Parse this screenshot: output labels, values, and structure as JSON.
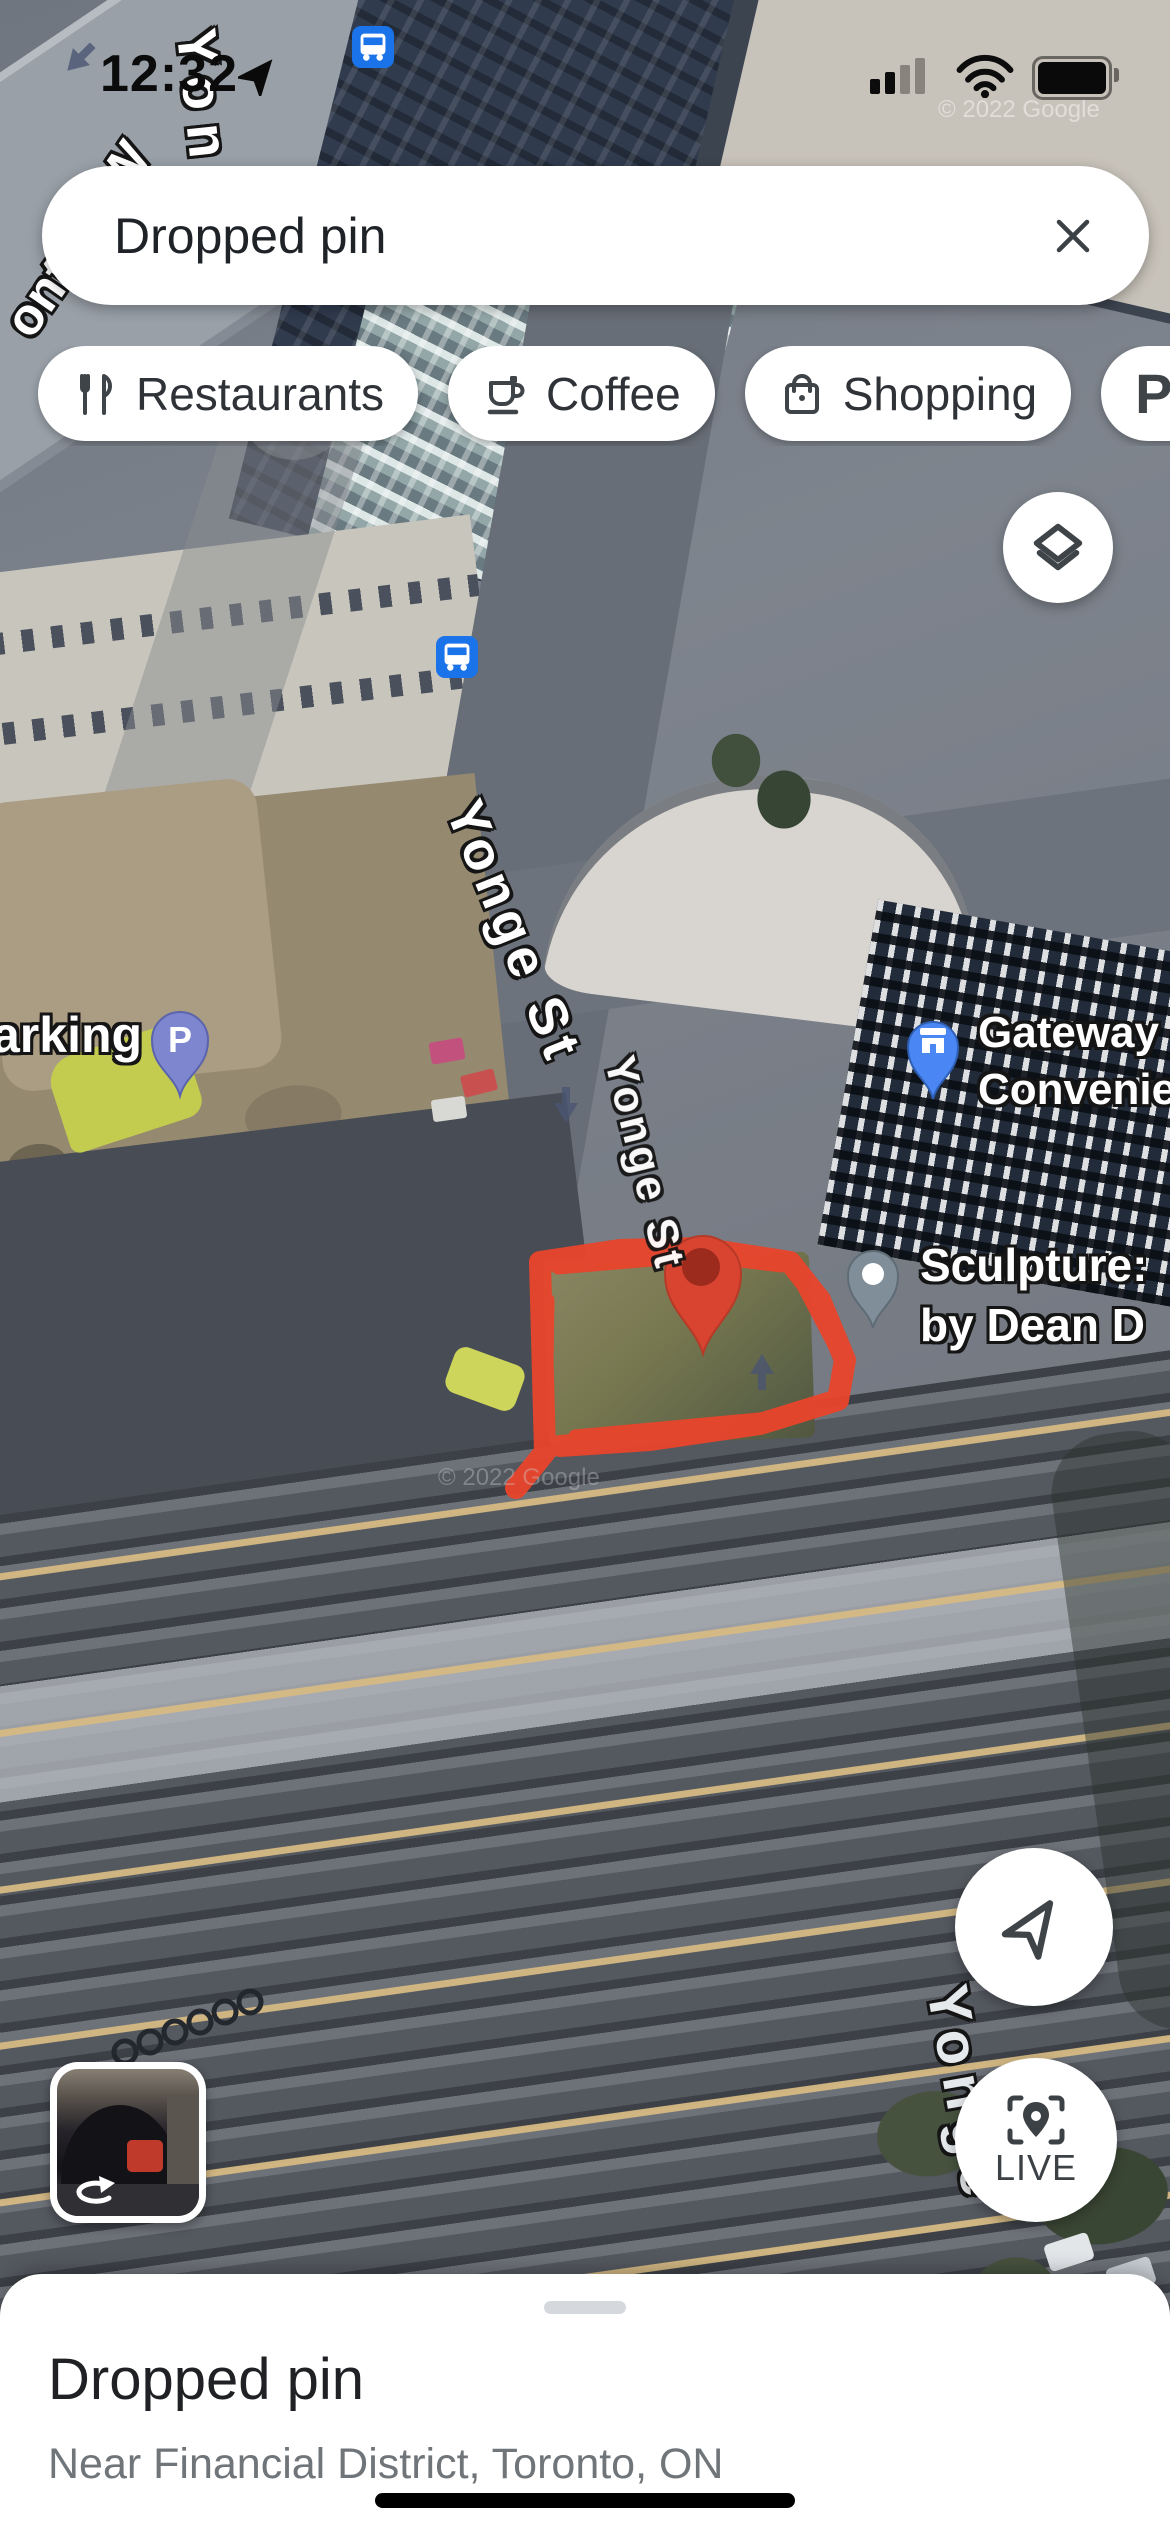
{
  "status_bar": {
    "time": "12:32"
  },
  "search_bar": {
    "query": "Dropped pin"
  },
  "chips": {
    "restaurants": "Restaurants",
    "coffee": "Coffee",
    "shopping": "Shopping",
    "parking": "Parking",
    "parking_icon": "P"
  },
  "map": {
    "labels": {
      "street_fragment_yong": "Yong",
      "street_fragment_w": "W",
      "street_fragment_ont": "ont",
      "yonge_main": "Yonge St",
      "yonge_lower": "Yonge St",
      "yonge_bottom": "Yonge",
      "parking_partial": "arking",
      "gateway_line1": "Gateway",
      "gateway_line2": "Convenience",
      "sculpture_line1": "Sculpture:",
      "sculpture_line2": "by Dean D",
      "watermark_top": "© 2022 Google",
      "watermark_bottom": "© 2022 Google"
    },
    "buttons": {
      "live": "LIVE"
    },
    "colors": {
      "dropped_pin": "#D8442F",
      "scribble": "#E8452C",
      "gateway_pin": "#4A87F5",
      "sculpture_pin": "#7F8E99",
      "parking_pin": "#7D86CF",
      "transit_icon": "#1A73E8"
    }
  },
  "bottom_sheet": {
    "title": "Dropped pin",
    "subtitle": "Near Financial District, Toronto, ON"
  }
}
